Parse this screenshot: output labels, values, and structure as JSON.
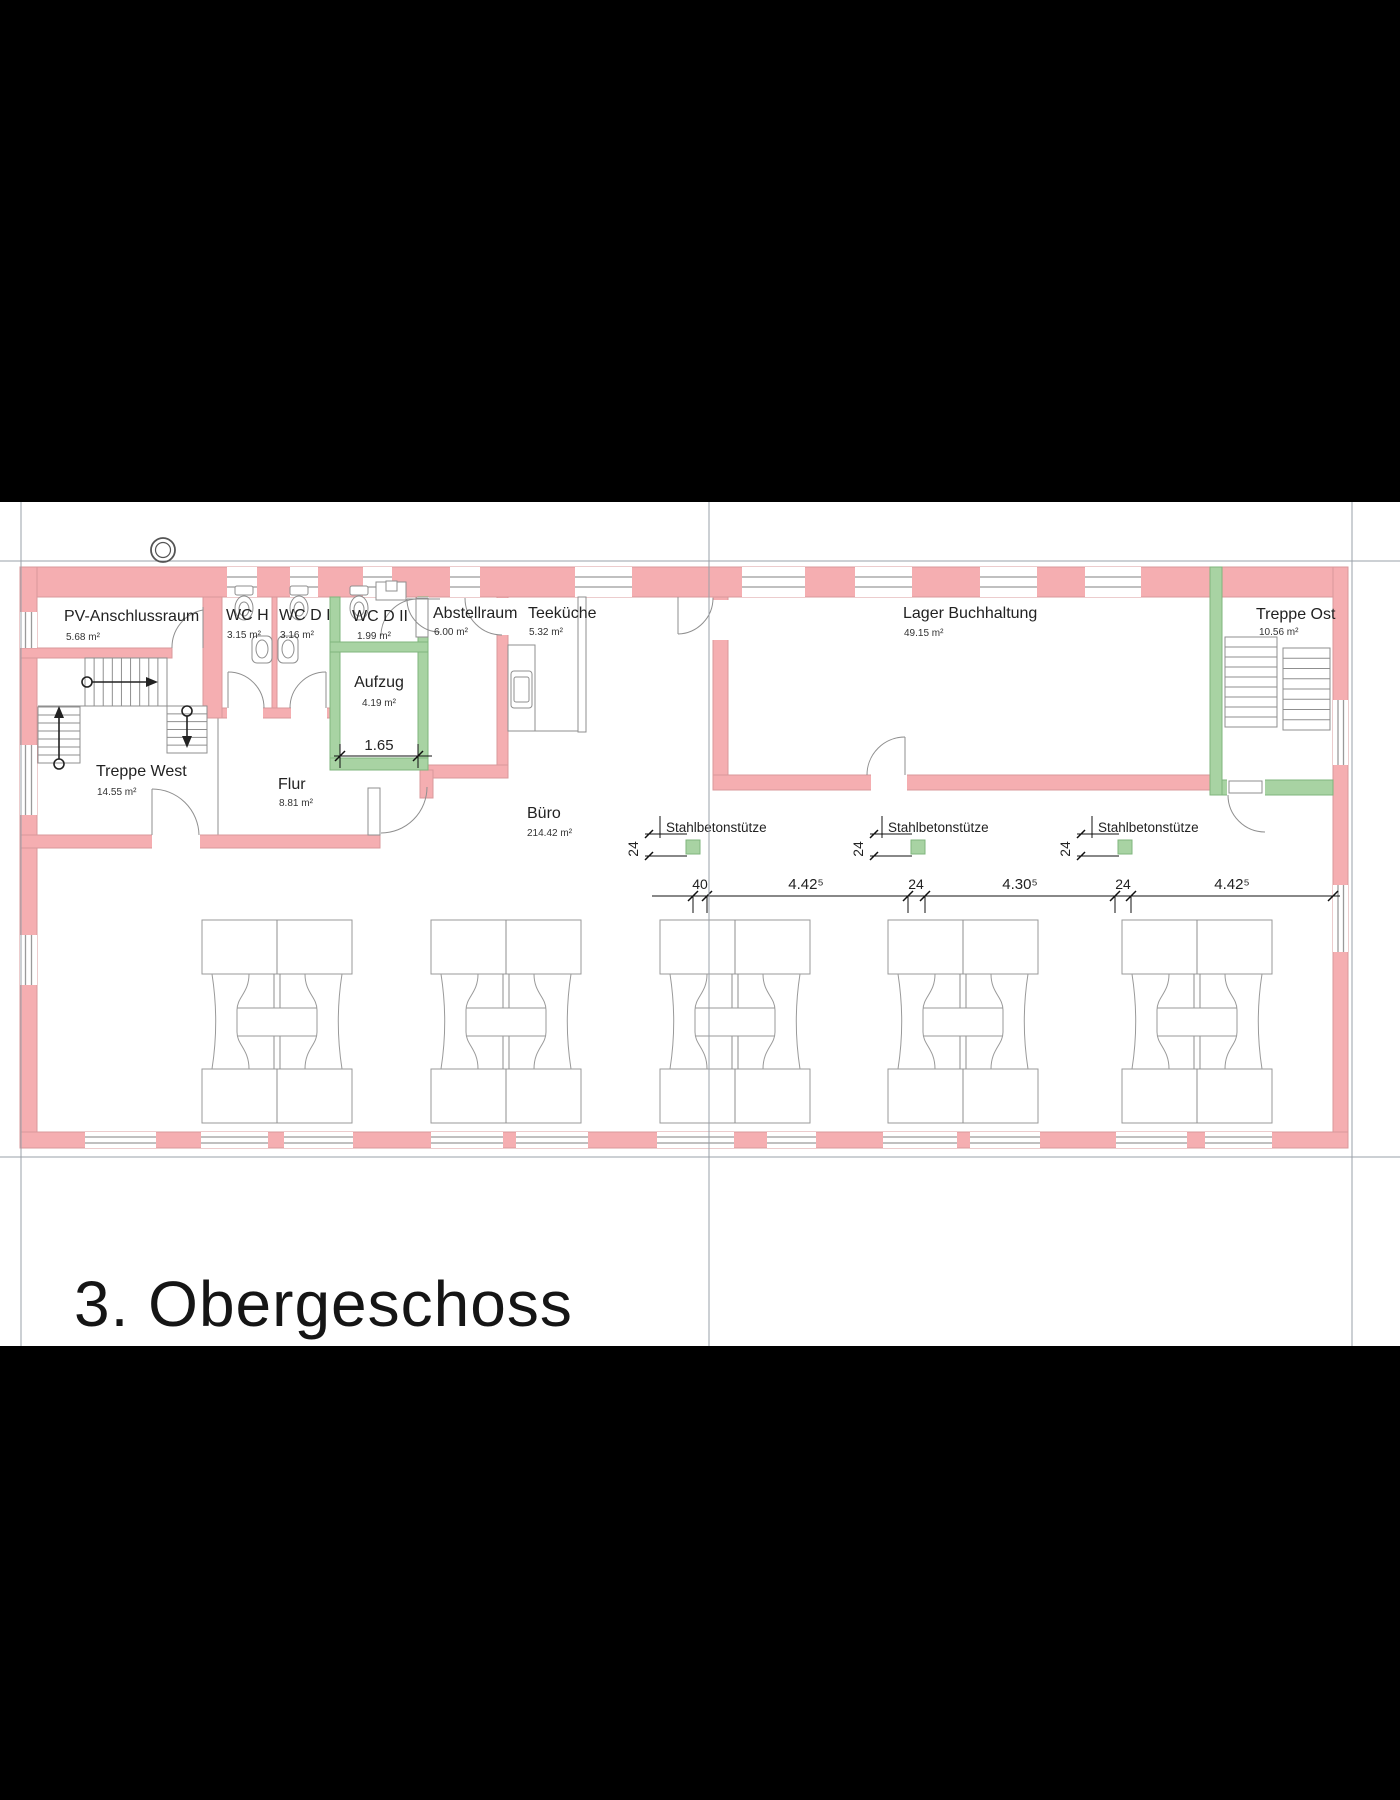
{
  "title": "3. Obergeschoss",
  "rooms": {
    "pv": {
      "name": "PV-Anschlussraum",
      "area": "5.68 m²"
    },
    "wc_h": {
      "name": "WC H",
      "area": "3.15 m²"
    },
    "wc_d_i": {
      "name": "WC D I",
      "area": "3.16 m²"
    },
    "wc_d_ii": {
      "name": "WC D II",
      "area": "1.99 m²"
    },
    "abstellraum": {
      "name": "Abstellraum",
      "area": "6.00 m²"
    },
    "teekueche": {
      "name": "Teeküche",
      "area": "5.32 m²"
    },
    "aufzug": {
      "name": "Aufzug",
      "area": "4.19 m²"
    },
    "treppe_west": {
      "name": "Treppe West",
      "area": "14.55 m²"
    },
    "flur": {
      "name": "Flur",
      "area": "8.81 m²"
    },
    "buero": {
      "name": "Büro",
      "area": "214.42 m²"
    },
    "lager": {
      "name": "Lager Buchhaltung",
      "area": "49.15 m²"
    },
    "treppe_ost": {
      "name": "Treppe Ost",
      "area": "10.56 m²"
    }
  },
  "columns": {
    "label": "Stahlbetonstütze",
    "dim": "24"
  },
  "dims": {
    "aufzug_width": "1.65",
    "chain": [
      "40",
      "4.42⁵",
      "24",
      "4.30⁵",
      "24",
      "4.42⁵"
    ]
  },
  "colors": {
    "wall_pink": "#F5AEB1",
    "wall_pink_outline": "#D9989B",
    "wall_green": "#A8D3A3",
    "wall_green_outline": "#7FB67C",
    "drawing_gray": "#8F8F8F",
    "frame_gray": "#9AA0A8",
    "text_dark": "#222222"
  }
}
